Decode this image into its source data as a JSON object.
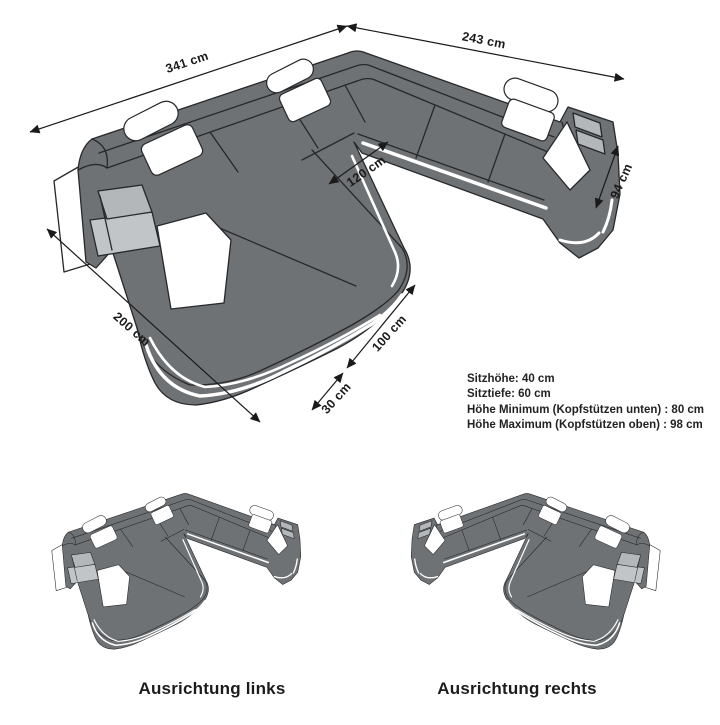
{
  "page": {
    "background": "#ffffff"
  },
  "sofa_colors": {
    "body_gray": "#6f7275",
    "shelf_panel_gray": "#b4b7ba",
    "under_shelf_gray": "#c2c5c7",
    "outline": "#26282a",
    "accent_white": "#ffffff"
  },
  "dimensions": {
    "back_left": {
      "label": "341 cm"
    },
    "back_right": {
      "label": "243 cm"
    },
    "opening": {
      "label": "120 cm"
    },
    "depth_right": {
      "label": "94 cm"
    },
    "chaise_length": {
      "label": "200 cm"
    },
    "chaise_width": {
      "label": "100 cm"
    },
    "front_strip": {
      "label": "30 cm"
    }
  },
  "specs": {
    "lines": [
      "Sitzhöhe: 40 cm",
      "Sitztiefe: 60 cm",
      "Höhe Minimum (Kopfstützen unten) : 80 cm",
      "Höhe Maximum (Kopfstützen oben) : 98 cm"
    ]
  },
  "variants": {
    "left": {
      "label": "Ausrichtung links"
    },
    "right": {
      "label": "Ausrichtung rechts"
    }
  }
}
